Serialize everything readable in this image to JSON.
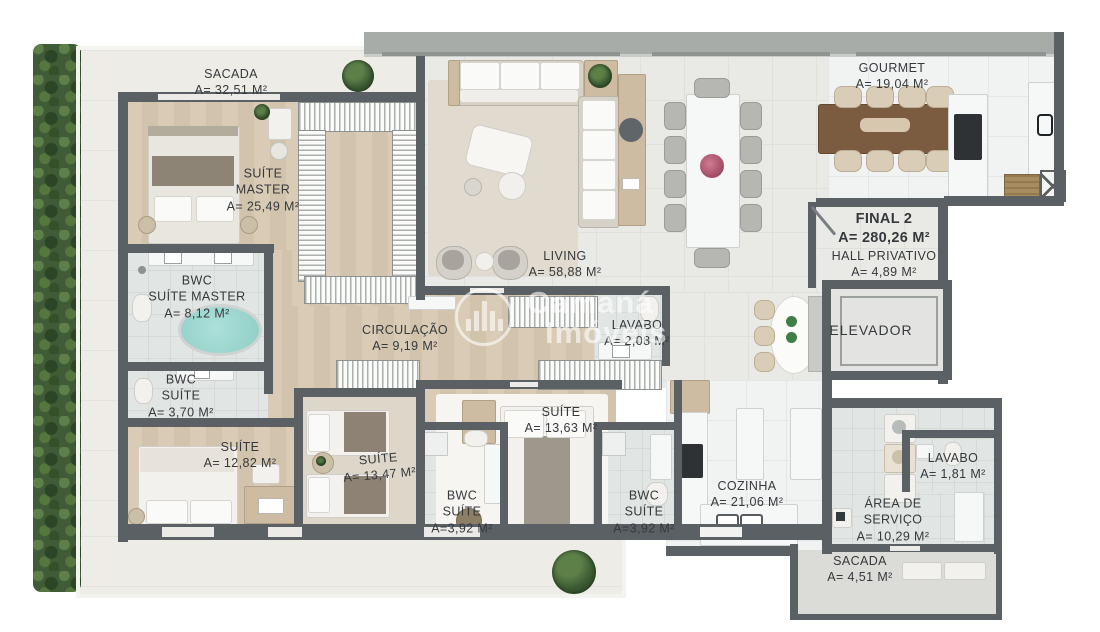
{
  "watermark": {
    "line1": "Camaná",
    "line2": "Imóveis"
  },
  "unit": {
    "label": "FINAL 2",
    "area": "A= 280,26 M²"
  },
  "rooms": [
    {
      "id": "sacada-top",
      "line1": "SACADA",
      "area": "A= 32,51 M²"
    },
    {
      "id": "suite-master",
      "line1": "SUÍTE",
      "line2": "MASTER",
      "area": "A= 25,49 M²"
    },
    {
      "id": "bwc-suite-master",
      "line1": "BWC",
      "line2": "SUÍTE MASTER",
      "area": "A= 8,12 M²"
    },
    {
      "id": "bwc-suite",
      "line1": "BWC",
      "line2": "SUÍTE",
      "area": "A= 3,70 M²"
    },
    {
      "id": "suite-1282",
      "line1": "SUÍTE",
      "area": "A= 12,82 M²"
    },
    {
      "id": "suite-1347",
      "line1": "SUÍTE",
      "area": "A= 13,47 M²"
    },
    {
      "id": "circulacao",
      "line1": "CIRCULAÇÃO",
      "area": "A= 9,19 M²"
    },
    {
      "id": "living",
      "line1": "LIVING",
      "area": "A= 58,88 M²"
    },
    {
      "id": "lavabo-208",
      "line1": "LAVABO",
      "area": "A= 2,08 M²"
    },
    {
      "id": "suite-1363",
      "line1": "SUÍTE",
      "area": "A= 13,63 M²"
    },
    {
      "id": "bwc-392-left",
      "line1": "BWC",
      "line2": "SUÍTE",
      "area": "A=3,92 M²"
    },
    {
      "id": "bwc-392-right",
      "line1": "BWC",
      "line2": "SUÍTE",
      "area": "A=3,92 M²"
    },
    {
      "id": "cozinha",
      "line1": "COZINHA",
      "area": "A= 21,06 M²"
    },
    {
      "id": "gourmet",
      "line1": "GOURMET",
      "area": "A= 19,04 M²"
    },
    {
      "id": "hall-privativo",
      "line1": "HALL PRIVATIVO",
      "area": "A= 4,89 M²"
    },
    {
      "id": "elevador",
      "line1": "ELEVADOR"
    },
    {
      "id": "lavabo-181",
      "line1": "LAVABO",
      "area": "A= 1,81 M²"
    },
    {
      "id": "area-servico",
      "line1": "ÁREA DE",
      "line2": "SERVIÇO",
      "area": "A= 10,29 M²"
    },
    {
      "id": "sacada-451",
      "line1": "SACADA",
      "area": "A= 4,51 M²"
    }
  ],
  "palette": {
    "wall": "#5b6065",
    "wood_floor": "#d6c8b2",
    "living_tile": "#e9eae6",
    "bath_tile": "#e1e5e3",
    "marble": "#f1f2f2",
    "balcony": "#edece7",
    "hedge_green": "#3f5c37",
    "label_text": "#36393c",
    "tub_water": "#9fd4cf",
    "gourmet_table_wood": "#7b5c40"
  }
}
